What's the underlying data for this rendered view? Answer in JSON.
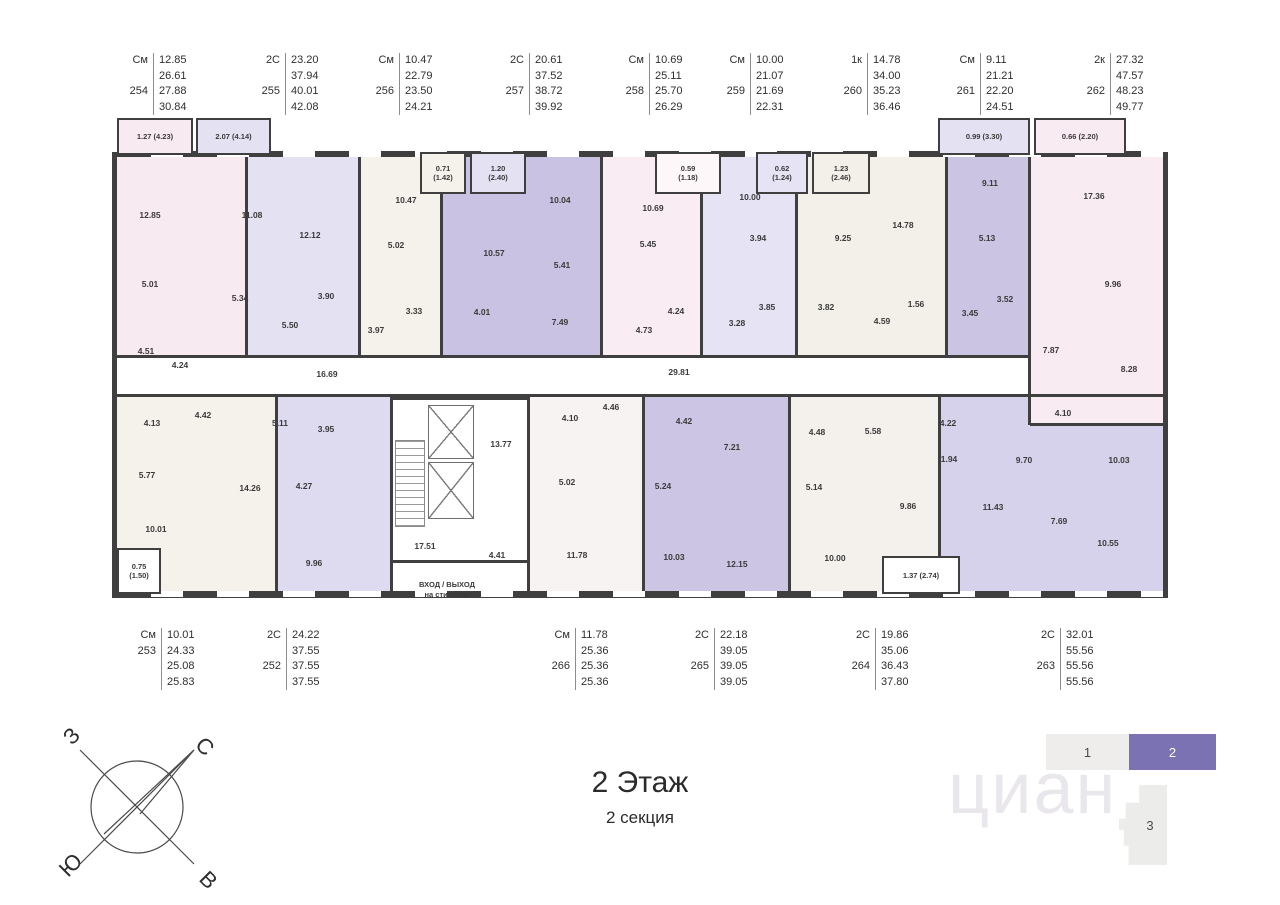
{
  "title": {
    "main": "2 Этаж",
    "sub": "2 секция"
  },
  "compass": {
    "west": "З",
    "north": "С",
    "south": "Ю",
    "east": "В"
  },
  "watermark": "циан",
  "selector": {
    "sections": [
      {
        "label": "1",
        "active": false
      },
      {
        "label": "2",
        "active": true
      }
    ],
    "active_color": "#7b72b4",
    "tower": "3"
  },
  "entrance": {
    "line1": "ВХОД / ВЫХОД",
    "line2": "на стилобат"
  },
  "header_units": [
    {
      "num": "254",
      "x": 108,
      "rows": [
        [
          "См",
          "12.85"
        ],
        [
          "",
          "26.61"
        ],
        [
          "254",
          "27.88"
        ],
        [
          "",
          "30.84"
        ]
      ]
    },
    {
      "num": "255",
      "x": 240,
      "rows": [
        [
          "2С",
          "23.20"
        ],
        [
          "",
          "37.94"
        ],
        [
          "255",
          "40.01"
        ],
        [
          "",
          "42.08"
        ]
      ]
    },
    {
      "num": "256",
      "x": 354,
      "rows": [
        [
          "См",
          "10.47"
        ],
        [
          "",
          "22.79"
        ],
        [
          "256",
          "23.50"
        ],
        [
          "",
          "24.21"
        ]
      ]
    },
    {
      "num": "257",
      "x": 484,
      "rows": [
        [
          "2С",
          "20.61"
        ],
        [
          "",
          "37.52"
        ],
        [
          "257",
          "38.72"
        ],
        [
          "",
          "39.92"
        ]
      ]
    },
    {
      "num": "258",
      "x": 604,
      "rows": [
        [
          "См",
          "10.69"
        ],
        [
          "",
          "25.11"
        ],
        [
          "258",
          "25.70"
        ],
        [
          "",
          "26.29"
        ]
      ]
    },
    {
      "num": "259",
      "x": 705,
      "rows": [
        [
          "См",
          "10.00"
        ],
        [
          "",
          "21.07"
        ],
        [
          "259",
          "21.69"
        ],
        [
          "",
          "22.31"
        ]
      ]
    },
    {
      "num": "260",
      "x": 822,
      "rows": [
        [
          "1к",
          "14.78"
        ],
        [
          "",
          "34.00"
        ],
        [
          "260",
          "35.23"
        ],
        [
          "",
          "36.46"
        ]
      ]
    },
    {
      "num": "261",
      "x": 935,
      "rows": [
        [
          "См",
          "9.11"
        ],
        [
          "",
          "21.21"
        ],
        [
          "261",
          "22.20"
        ],
        [
          "",
          "24.51"
        ]
      ]
    },
    {
      "num": "262",
      "x": 1065,
      "rows": [
        [
          "2к",
          "27.32"
        ],
        [
          "",
          "47.57"
        ],
        [
          "262",
          "48.23"
        ],
        [
          "",
          "49.77"
        ]
      ]
    }
  ],
  "footer_units": [
    {
      "num": "253",
      "x": 116,
      "rows": [
        [
          "См",
          "10.01"
        ],
        [
          "253",
          "24.33"
        ],
        [
          "",
          "25.08"
        ],
        [
          "",
          "25.83"
        ]
      ]
    },
    {
      "num": "252",
      "x": 241,
      "rows": [
        [
          "2С",
          "24.22"
        ],
        [
          "",
          "37.55"
        ],
        [
          "252",
          "37.55"
        ],
        [
          "",
          "37.55"
        ]
      ]
    },
    {
      "num": "266",
      "x": 530,
      "rows": [
        [
          "См",
          "11.78"
        ],
        [
          "",
          "25.36"
        ],
        [
          "266",
          "25.36"
        ],
        [
          "",
          "25.36"
        ]
      ]
    },
    {
      "num": "265",
      "x": 669,
      "rows": [
        [
          "2С",
          "22.18"
        ],
        [
          "",
          "39.05"
        ],
        [
          "265",
          "39.05"
        ],
        [
          "",
          "39.05"
        ]
      ]
    },
    {
      "num": "264",
      "x": 830,
      "rows": [
        [
          "2С",
          "19.86"
        ],
        [
          "",
          "35.06"
        ],
        [
          "264",
          "36.43"
        ],
        [
          "",
          "37.80"
        ]
      ]
    },
    {
      "num": "263",
      "x": 1015,
      "rows": [
        [
          "2С",
          "32.01"
        ],
        [
          "",
          "55.56"
        ],
        [
          "263",
          "55.56"
        ],
        [
          "",
          "55.56"
        ]
      ]
    }
  ],
  "plan": {
    "wall_color": "#3f3f3f",
    "regions": [
      {
        "name": "254",
        "x": 117,
        "y": 157,
        "w": 128,
        "h": 198,
        "fill": "#f8eaf1"
      },
      {
        "name": "255",
        "x": 245,
        "y": 157,
        "w": 113,
        "h": 198,
        "fill": "#e4e1f2"
      },
      {
        "name": "256",
        "x": 358,
        "y": 157,
        "w": 82,
        "h": 198,
        "fill": "#f5f2ec"
      },
      {
        "name": "257",
        "x": 440,
        "y": 157,
        "w": 160,
        "h": 198,
        "fill": "#c9c2e2"
      },
      {
        "name": "258",
        "x": 600,
        "y": 157,
        "w": 100,
        "h": 198,
        "fill": "#f9ecf2"
      },
      {
        "name": "259",
        "x": 700,
        "y": 157,
        "w": 95,
        "h": 198,
        "fill": "#e6e3f4"
      },
      {
        "name": "260",
        "x": 795,
        "y": 157,
        "w": 150,
        "h": 198,
        "fill": "#f3f0ea"
      },
      {
        "name": "261",
        "x": 945,
        "y": 157,
        "w": 85,
        "h": 198,
        "fill": "#cbc4e3"
      },
      {
        "name": "263",
        "x": 940,
        "y": 397,
        "w": 223,
        "h": 196,
        "fill": "#d7d2eb"
      },
      {
        "name": "262",
        "x": 1030,
        "y": 157,
        "w": 133,
        "h": 268,
        "fill": "#f8ebf1"
      },
      {
        "name": "253",
        "x": 117,
        "y": 397,
        "w": 158,
        "h": 196,
        "fill": "#f5f2ec"
      },
      {
        "name": "252",
        "x": 275,
        "y": 397,
        "w": 115,
        "h": 196,
        "fill": "#dedaf0"
      },
      {
        "name": "266",
        "x": 530,
        "y": 397,
        "w": 115,
        "h": 196,
        "fill": "#f8f3f3"
      },
      {
        "name": "265",
        "x": 645,
        "y": 397,
        "w": 145,
        "h": 196,
        "fill": "#ccc5e4"
      },
      {
        "name": "264",
        "x": 790,
        "y": 397,
        "w": 150,
        "h": 196,
        "fill": "#f4f1ed"
      },
      {
        "name": "corridor",
        "x": 117,
        "y": 358,
        "w": 911,
        "h": 36,
        "fill": "#ffffff"
      }
    ],
    "walls": [
      {
        "x": 117,
        "y": 355,
        "w": 911,
        "h": 3
      },
      {
        "x": 117,
        "y": 394,
        "w": 1046,
        "h": 3
      },
      {
        "x": 245,
        "y": 157,
        "w": 3,
        "h": 198
      },
      {
        "x": 358,
        "y": 157,
        "w": 3,
        "h": 198
      },
      {
        "x": 440,
        "y": 157,
        "w": 3,
        "h": 198
      },
      {
        "x": 600,
        "y": 157,
        "w": 3,
        "h": 198
      },
      {
        "x": 700,
        "y": 157,
        "w": 3,
        "h": 198
      },
      {
        "x": 795,
        "y": 157,
        "w": 3,
        "h": 198
      },
      {
        "x": 945,
        "y": 157,
        "w": 3,
        "h": 198
      },
      {
        "x": 1028,
        "y": 157,
        "w": 3,
        "h": 268
      },
      {
        "x": 1030,
        "y": 423,
        "w": 133,
        "h": 3
      },
      {
        "x": 275,
        "y": 397,
        "w": 3,
        "h": 196
      },
      {
        "x": 390,
        "y": 397,
        "w": 3,
        "h": 196
      },
      {
        "x": 527,
        "y": 397,
        "w": 3,
        "h": 196
      },
      {
        "x": 642,
        "y": 397,
        "w": 3,
        "h": 196
      },
      {
        "x": 788,
        "y": 397,
        "w": 3,
        "h": 196
      },
      {
        "x": 938,
        "y": 397,
        "w": 3,
        "h": 196
      }
    ],
    "balconies": [
      {
        "x": 117,
        "y": 118,
        "w": 76,
        "h": 37,
        "fill": "#f8eaf1",
        "label": "1.27 (4.23)"
      },
      {
        "x": 196,
        "y": 118,
        "w": 75,
        "h": 37,
        "fill": "#e4e1f2",
        "label": "2.07 (4.14)"
      },
      {
        "x": 938,
        "y": 118,
        "w": 92,
        "h": 37,
        "fill": "#e4e1f2",
        "label": "0.99 (3.30)"
      },
      {
        "x": 1034,
        "y": 118,
        "w": 92,
        "h": 37,
        "fill": "#f8ebf1",
        "label": "0.66 (2.20)"
      },
      {
        "x": 420,
        "y": 152,
        "w": 46,
        "h": 42,
        "fill": "#f5f2ec",
        "label": "0.71\n(1.42)"
      },
      {
        "x": 470,
        "y": 152,
        "w": 56,
        "h": 42,
        "fill": "#e4e1f2",
        "label": "1.20\n(2.40)"
      },
      {
        "x": 655,
        "y": 152,
        "w": 66,
        "h": 42,
        "fill": "#fdf7fa",
        "label": "0.59\n(1.18)"
      },
      {
        "x": 756,
        "y": 152,
        "w": 52,
        "h": 42,
        "fill": "#e6e3f4",
        "label": "0.62\n(1.24)"
      },
      {
        "x": 812,
        "y": 152,
        "w": 58,
        "h": 42,
        "fill": "#f3f0ea",
        "label": "1.23\n(2.46)"
      },
      {
        "x": 117,
        "y": 548,
        "w": 44,
        "h": 46,
        "fill": "#ffffff",
        "label": "0.75\n(1.50)"
      },
      {
        "x": 882,
        "y": 556,
        "w": 78,
        "h": 38,
        "fill": "#ffffff",
        "label": "1.37 (2.74)"
      }
    ],
    "labels": [
      {
        "x": 150,
        "y": 215,
        "t": "12.85"
      },
      {
        "x": 150,
        "y": 284,
        "t": "5.01"
      },
      {
        "x": 146,
        "y": 351,
        "t": "4.51"
      },
      {
        "x": 180,
        "y": 365,
        "t": "4.24"
      },
      {
        "x": 252,
        "y": 215,
        "t": "11.08"
      },
      {
        "x": 310,
        "y": 235,
        "t": "12.12"
      },
      {
        "x": 240,
        "y": 298,
        "t": "5.34"
      },
      {
        "x": 326,
        "y": 296,
        "t": "3.90"
      },
      {
        "x": 290,
        "y": 325,
        "t": "5.50"
      },
      {
        "x": 406,
        "y": 200,
        "t": "10.47"
      },
      {
        "x": 396,
        "y": 245,
        "t": "5.02"
      },
      {
        "x": 414,
        "y": 311,
        "t": "3.33"
      },
      {
        "x": 376,
        "y": 330,
        "t": "3.97"
      },
      {
        "x": 494,
        "y": 253,
        "t": "10.57"
      },
      {
        "x": 560,
        "y": 200,
        "t": "10.04"
      },
      {
        "x": 562,
        "y": 265,
        "t": "5.41"
      },
      {
        "x": 482,
        "y": 312,
        "t": "4.01"
      },
      {
        "x": 560,
        "y": 322,
        "t": "7.49"
      },
      {
        "x": 653,
        "y": 208,
        "t": "10.69"
      },
      {
        "x": 648,
        "y": 244,
        "t": "5.45"
      },
      {
        "x": 676,
        "y": 311,
        "t": "4.24"
      },
      {
        "x": 644,
        "y": 330,
        "t": "4.73"
      },
      {
        "x": 750,
        "y": 197,
        "t": "10.00"
      },
      {
        "x": 758,
        "y": 238,
        "t": "3.94"
      },
      {
        "x": 767,
        "y": 307,
        "t": "3.85"
      },
      {
        "x": 737,
        "y": 323,
        "t": "3.28"
      },
      {
        "x": 903,
        "y": 225,
        "t": "14.78"
      },
      {
        "x": 843,
        "y": 238,
        "t": "9.25"
      },
      {
        "x": 826,
        "y": 307,
        "t": "3.82"
      },
      {
        "x": 916,
        "y": 304,
        "t": "1.56"
      },
      {
        "x": 882,
        "y": 321,
        "t": "4.59"
      },
      {
        "x": 990,
        "y": 183,
        "t": "9.11"
      },
      {
        "x": 987,
        "y": 238,
        "t": "5.13"
      },
      {
        "x": 1005,
        "y": 299,
        "t": "3.52"
      },
      {
        "x": 970,
        "y": 313,
        "t": "3.45"
      },
      {
        "x": 1094,
        "y": 196,
        "t": "17.36"
      },
      {
        "x": 1113,
        "y": 284,
        "t": "9.96"
      },
      {
        "x": 1051,
        "y": 350,
        "t": "7.87"
      },
      {
        "x": 1129,
        "y": 369,
        "t": "8.28"
      },
      {
        "x": 1063,
        "y": 413,
        "t": "4.10"
      },
      {
        "x": 327,
        "y": 374,
        "t": "16.69"
      },
      {
        "x": 679,
        "y": 372,
        "t": "29.81"
      },
      {
        "x": 501,
        "y": 444,
        "t": "13.77"
      },
      {
        "x": 425,
        "y": 546,
        "t": "17.51"
      },
      {
        "x": 497,
        "y": 555,
        "t": "4.41"
      },
      {
        "x": 152,
        "y": 423,
        "t": "4.13"
      },
      {
        "x": 203,
        "y": 415,
        "t": "4.42"
      },
      {
        "x": 147,
        "y": 475,
        "t": "5.77"
      },
      {
        "x": 156,
        "y": 529,
        "t": "10.01"
      },
      {
        "x": 280,
        "y": 423,
        "t": "5.11"
      },
      {
        "x": 326,
        "y": 429,
        "t": "3.95"
      },
      {
        "x": 250,
        "y": 488,
        "t": "14.26"
      },
      {
        "x": 304,
        "y": 486,
        "t": "4.27"
      },
      {
        "x": 314,
        "y": 563,
        "t": "9.96"
      },
      {
        "x": 570,
        "y": 418,
        "t": "4.10"
      },
      {
        "x": 611,
        "y": 407,
        "t": "4.46"
      },
      {
        "x": 567,
        "y": 482,
        "t": "5.02"
      },
      {
        "x": 577,
        "y": 555,
        "t": "11.78"
      },
      {
        "x": 684,
        "y": 421,
        "t": "4.42"
      },
      {
        "x": 732,
        "y": 447,
        "t": "7.21"
      },
      {
        "x": 663,
        "y": 486,
        "t": "5.24"
      },
      {
        "x": 674,
        "y": 557,
        "t": "10.03"
      },
      {
        "x": 737,
        "y": 564,
        "t": "12.15"
      },
      {
        "x": 817,
        "y": 432,
        "t": "4.48"
      },
      {
        "x": 873,
        "y": 431,
        "t": "5.58"
      },
      {
        "x": 814,
        "y": 487,
        "t": "5.14"
      },
      {
        "x": 908,
        "y": 506,
        "t": "9.86"
      },
      {
        "x": 835,
        "y": 558,
        "t": "10.00"
      },
      {
        "x": 948,
        "y": 423,
        "t": "4.22"
      },
      {
        "x": 949,
        "y": 459,
        "t": "1.94"
      },
      {
        "x": 1024,
        "y": 460,
        "t": "9.70"
      },
      {
        "x": 1119,
        "y": 460,
        "t": "10.03"
      },
      {
        "x": 993,
        "y": 507,
        "t": "11.43"
      },
      {
        "x": 1059,
        "y": 521,
        "t": "7.69"
      },
      {
        "x": 1108,
        "y": 543,
        "t": "10.55"
      }
    ]
  }
}
